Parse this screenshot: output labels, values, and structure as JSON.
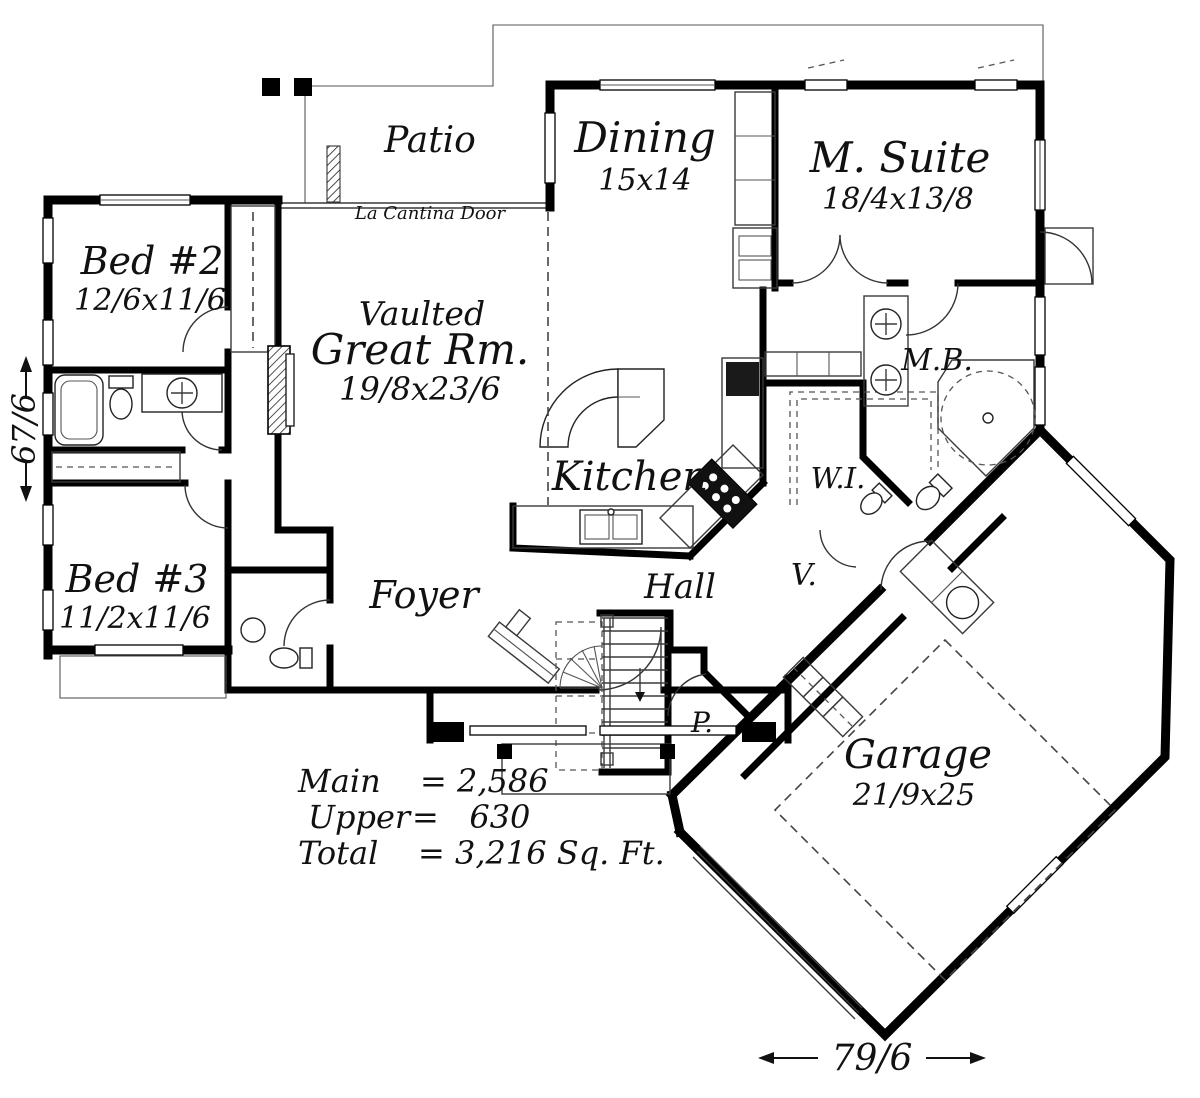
{
  "colors": {
    "wall": "#000000",
    "thin_line": "#3a3a3a",
    "background": "#ffffff",
    "text": "#111111"
  },
  "rooms": {
    "patio": {
      "name": "Patio"
    },
    "dining": {
      "name": "Dining",
      "dims": "15x14"
    },
    "m_suite": {
      "name": "M. Suite",
      "dims": "18/4x13/8"
    },
    "bed2": {
      "name": "Bed #2",
      "dims": "12/6x11/6"
    },
    "great_rm": {
      "prefix": "Vaulted",
      "name": "Great Rm.",
      "dims": "19/8x23/6"
    },
    "kitchen": {
      "name": "Kitchen"
    },
    "mb": {
      "name": "M.B."
    },
    "wi": {
      "name": "W.I."
    },
    "bed3": {
      "name": "Bed #3",
      "dims": "11/2x11/6"
    },
    "foyer": {
      "name": "Foyer"
    },
    "hall": {
      "name": "Hall"
    },
    "v": {
      "name": "V."
    },
    "p": {
      "name": "P."
    },
    "garage": {
      "name": "Garage",
      "dims": "21/9x25"
    }
  },
  "annotations": {
    "la_cantina_door": "La Cantina Door"
  },
  "area_summary": {
    "main": {
      "label": "Main",
      "value": "= 2,586"
    },
    "upper": {
      "label": "Upper",
      "value": "=   630"
    },
    "total": {
      "label": "Total",
      "value": "= 3,216 Sq. Ft."
    }
  },
  "dimensions": {
    "width": "79/6",
    "height": "67/6"
  }
}
